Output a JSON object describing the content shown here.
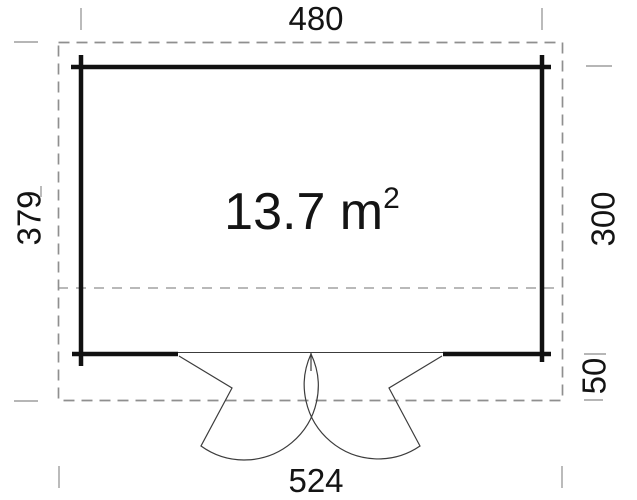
{
  "plan": {
    "area_label": {
      "value": "13.7 m",
      "superscript": "2"
    },
    "dimensions": {
      "top": "480",
      "left": "379",
      "right_upper": "300",
      "right_lower": "50",
      "bottom": "524"
    }
  },
  "colors": {
    "wall": "#111111",
    "door": "#3c3c3c",
    "outline": "#8f8f8f",
    "tick": "#9e9e9e",
    "text": "#141414"
  }
}
